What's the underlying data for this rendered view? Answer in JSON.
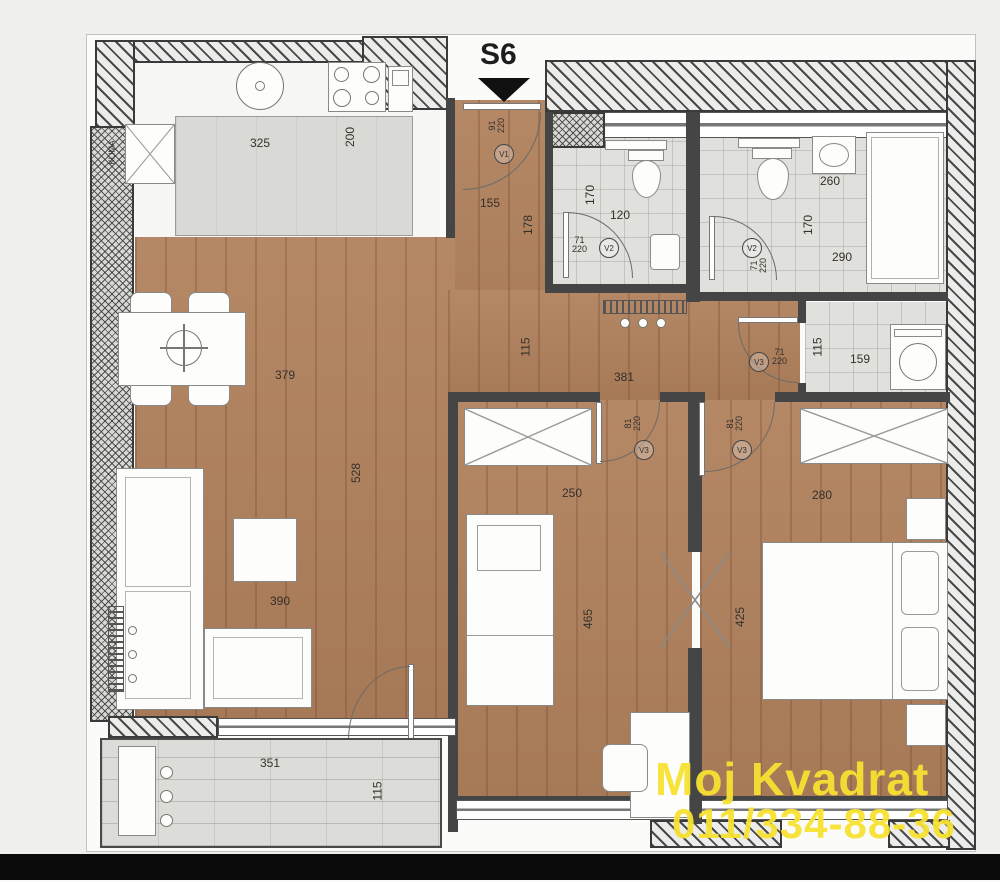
{
  "title": "S6",
  "watermark": {
    "line1": "Moj Kvadrat",
    "line2": "011/334-88-36",
    "color": "#F7E232"
  },
  "colors": {
    "wood": "#b0805c",
    "tile": "#e0e0dc",
    "wall": "#454545",
    "counter": "#d9d9d5"
  },
  "labels": {
    "klima": "KLIMA",
    "kitchen_width": "325",
    "kitchen_depth": "200",
    "entry_width": "155",
    "entry_depth": "178",
    "bath1_depth": "170",
    "bath1_width": "120",
    "bath2_sink": "260",
    "bath2_depth": "170",
    "bath2_width": "290",
    "storage_depth": "115",
    "storage_width": "159",
    "hall_depth": "115",
    "hall_width": "381",
    "living_width": "379",
    "living_depth": "528",
    "living_width2": "390",
    "bed1_width": "250",
    "bed1_depth": "465",
    "bed2_width": "280",
    "bed2_depth": "425",
    "terrace_width": "351",
    "terrace_depth": "115"
  },
  "doors": {
    "entry": {
      "w": "91",
      "h": "220",
      "tag": "V1"
    },
    "bath1": {
      "w": "71",
      "h": "220",
      "tag": "V2"
    },
    "bath2": {
      "w": "71",
      "h": "220",
      "tag": "V2"
    },
    "storage": {
      "w": "71",
      "h": "220",
      "tag": "V3"
    },
    "bed1": {
      "w": "81",
      "h": "220",
      "tag": "V3"
    },
    "bed2": {
      "w": "81",
      "h": "220",
      "tag": "V3"
    }
  }
}
